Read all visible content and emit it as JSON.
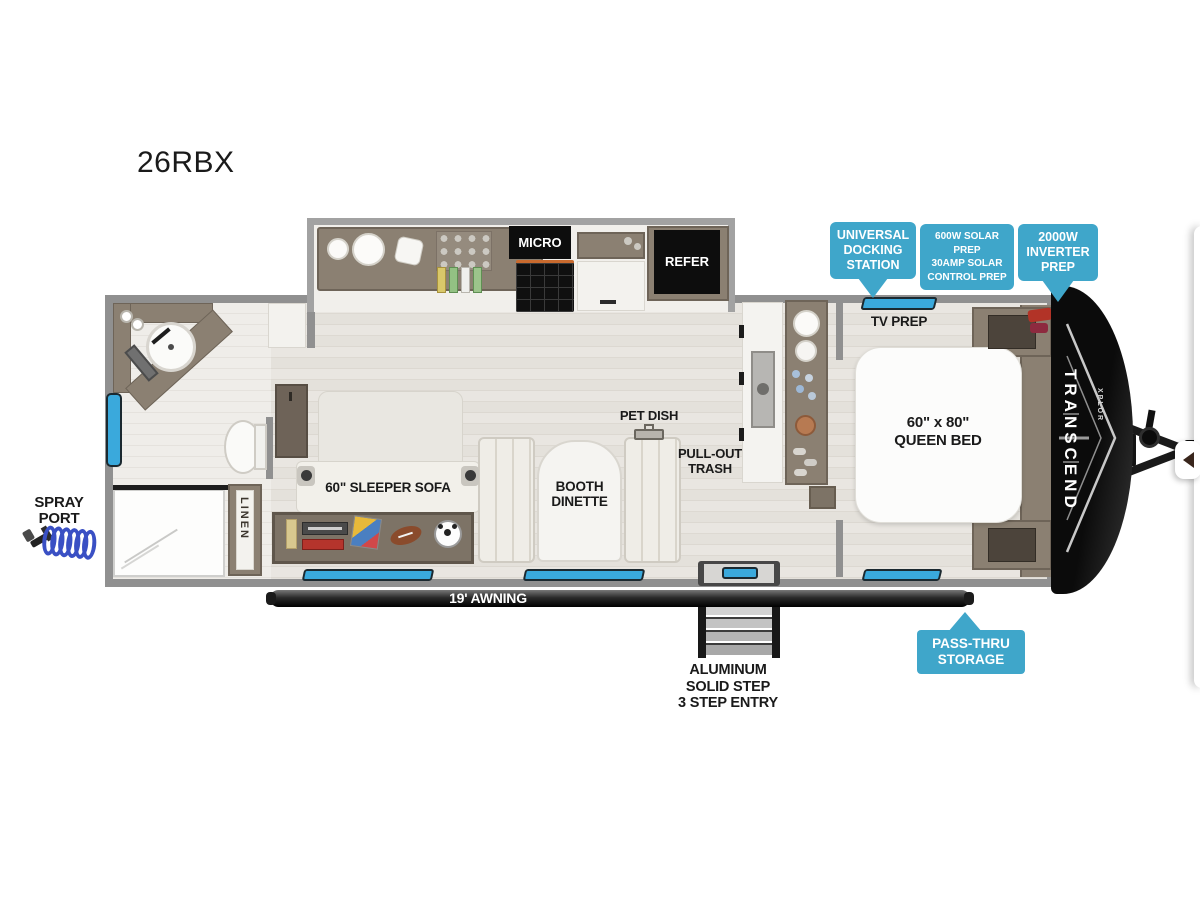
{
  "title": "26RBX",
  "brand": {
    "name": "TRANSCEND",
    "sub": "XPLOR"
  },
  "colors": {
    "callout_blue": "#3fa6ca",
    "window_blue": "#3aa9dc",
    "awning_dark": "#1c1c1c",
    "cabinet_brown": "#8b8072"
  },
  "callouts": {
    "docking": {
      "line1": "UNIVERSAL",
      "line2": "DOCKING",
      "line3": "STATION"
    },
    "solar": {
      "line1": "600W SOLAR PREP",
      "line2": "30AMP SOLAR",
      "line3": "CONTROL PREP"
    },
    "inverter": {
      "line1": "2000W",
      "line2": "INVERTER",
      "line3": "PREP"
    },
    "passthru": {
      "line1": "PASS-THRU",
      "line2": "STORAGE"
    }
  },
  "rooms": {
    "tv_prep": "TV PREP",
    "micro": "MICRO",
    "refer": "REFER",
    "queen_bed_line1": "60\" x 80\"",
    "queen_bed_line2": "QUEEN BED",
    "sleeper_sofa": "60\" SLEEPER SOFA",
    "dinette_line1": "BOOTH",
    "dinette_line2": "DINETTE",
    "pet_dish": "PET DISH",
    "trash_line1": "PULL-OUT",
    "trash_line2": "TRASH",
    "linen": "LINEN"
  },
  "exterior": {
    "spray_line1": "SPRAY",
    "spray_line2": "PORT",
    "awning": "19' AWNING",
    "steps_line1": "ALUMINUM",
    "steps_line2": "SOLID STEP",
    "steps_line3": "3 STEP ENTRY"
  }
}
